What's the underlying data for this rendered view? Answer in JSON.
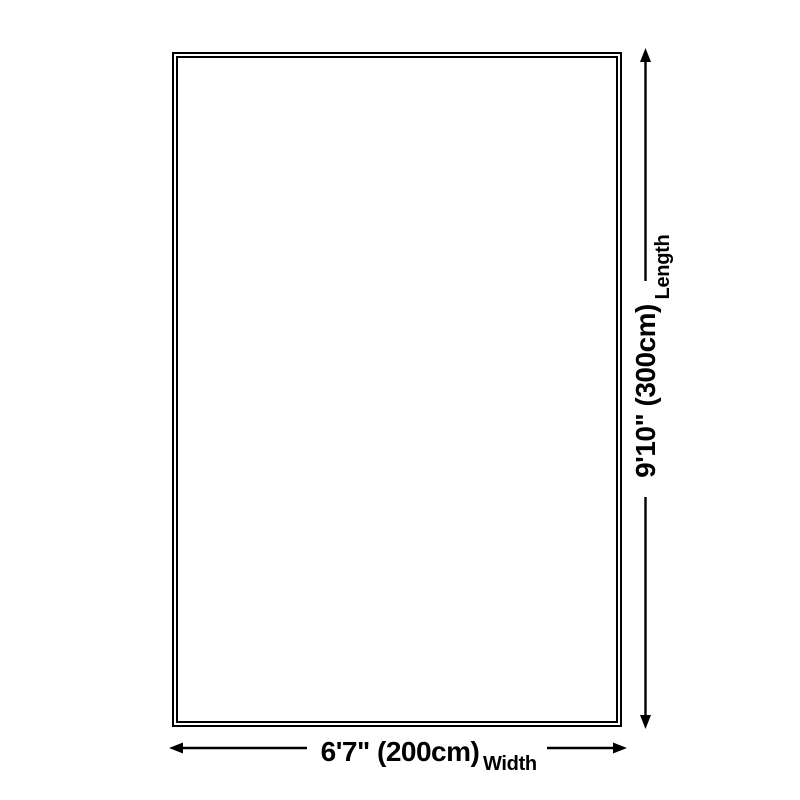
{
  "diagram": {
    "type": "product-dimensions",
    "background_color": "#ffffff",
    "line_color": "#000000",
    "outline": {
      "shape": "rectangle",
      "border_style": "double-line"
    },
    "dimensions": {
      "length": {
        "value": "9'10\" (300cm)",
        "label": "Length",
        "orientation": "vertical"
      },
      "width": {
        "value": "6'7\" (200cm)",
        "label": "Width",
        "orientation": "horizontal"
      }
    }
  }
}
